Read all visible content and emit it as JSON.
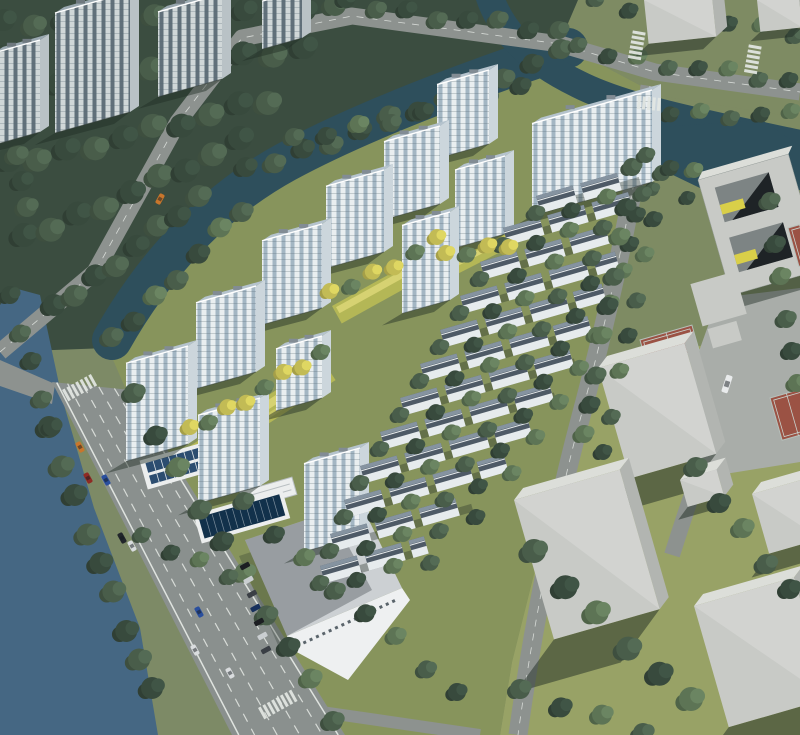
{
  "scene": {
    "kind": "aerial-architectural-rendering",
    "subject": "riverside residential development with high-rise towers, townhouse rows, canal, river, roads and context massing blocks",
    "width": 800,
    "height": 735
  },
  "palette": {
    "ground": "#7d8a66",
    "forest": "#3b4d40",
    "grass_context": "#7e8b63",
    "grass_site": "#87945c",
    "grass_sunny": "#98a266",
    "water_river": "#456783",
    "water_canal": "#2e4f5c",
    "road": "#8d928f",
    "road_arterial": "#8a908e",
    "plaza": "#a9ada9",
    "lane_white": "#dfe3df",
    "lane_dash": "#d7dbd7",
    "shadow": "rgba(32,44,36,0.45)",
    "tower_wall": "#e9eef0",
    "tower_glass": "#a3b6c3",
    "tower_roof": "#b5c3cd",
    "tower_side": "#ccd6dc",
    "old_wall": "#d0d7d8",
    "old_glass": "#61707a",
    "old_roof": "#9aa8b0",
    "old_side": "#b9c2c6",
    "th_wall": "#e6ebed",
    "th_roof": "#4e5a66",
    "th_roof_light": "#8593a0",
    "ridge": "#e9edee",
    "massing_front": "#c8cac6",
    "massing_top": "#dcded9",
    "massing_side": "#b2b5b1",
    "court_red": "#9b5244",
    "court_line": "#c9d3ce",
    "strip": "#b4b756",
    "strip_light": "#d6d272",
    "tree_dark": "#384a3d",
    "tree_mid": "#495d4a",
    "tree_light": "#5d7455",
    "tree_yellow": "#c2bb55",
    "solar_panel": "#2c4d70",
    "pool_dark": "#12314b",
    "white": "#eceeee",
    "wh_roof": "#ccd0d3",
    "wh_wall": "#eef0f1",
    "window_band": "#5a646b"
  },
  "buildings": {
    "towers": [
      [
        437,
        70,
        52,
        74
      ],
      [
        384,
        126,
        56,
        78
      ],
      [
        455,
        156,
        50,
        78
      ],
      [
        326,
        170,
        58,
        82
      ],
      [
        402,
        212,
        48,
        88
      ],
      [
        262,
        224,
        60,
        84
      ],
      [
        196,
        286,
        60,
        86
      ],
      [
        276,
        336,
        46,
        62
      ],
      [
        126,
        346,
        62,
        98
      ],
      [
        198,
        398,
        62,
        88
      ],
      [
        304,
        448,
        56,
        88
      ],
      [
        532,
        90,
        120,
        92
      ]
    ],
    "existing_towers": [
      [
        55,
        -8,
        75,
        120
      ],
      [
        158,
        -6,
        64,
        85
      ],
      [
        -6,
        40,
        46,
        92
      ],
      [
        262,
        -10,
        40,
        48
      ]
    ],
    "massing_blocks": [
      [
        598,
        368,
        90,
        115,
        42,
        -16
      ],
      [
        514,
        500,
        110,
        145,
        58,
        -16
      ],
      [
        694,
        606,
        104,
        126,
        46,
        -16
      ],
      [
        752,
        494,
        54,
        62,
        26,
        -16
      ],
      [
        680,
        480,
        38,
        28,
        14,
        -16
      ],
      [
        644,
        0,
        68,
        44,
        16,
        -6
      ],
      [
        757,
        0,
        42,
        32,
        12,
        -6
      ]
    ]
  },
  "townhouses": {
    "angle": -16,
    "rows": [
      [
        536,
        196,
        108
      ],
      [
        503,
        228,
        135
      ],
      [
        480,
        262,
        152
      ],
      [
        460,
        296,
        165
      ],
      [
        440,
        330,
        172
      ],
      [
        420,
        364,
        178
      ],
      [
        400,
        398,
        182
      ],
      [
        380,
        432,
        182
      ],
      [
        360,
        466,
        178
      ],
      [
        344,
        500,
        170
      ],
      [
        330,
        534,
        148
      ],
      [
        320,
        566,
        112
      ]
    ]
  },
  "tree_belts_back": [
    [
      10,
      25,
      330,
      10,
      12,
      11,
      "dark"
    ],
    [
      5,
      95,
      300,
      48,
      11,
      12,
      "dark"
    ],
    [
      15,
      165,
      265,
      100,
      10,
      12,
      "dark"
    ],
    [
      30,
      240,
      238,
      142,
      9,
      12,
      "dark"
    ],
    [
      60,
      310,
      198,
      196,
      8,
      11,
      "dark"
    ],
    [
      8,
      60,
      28,
      210,
      6,
      10,
      "dark"
    ],
    [
      252,
      172,
      556,
      54,
      12,
      10,
      "dark"
    ],
    [
      300,
      142,
      520,
      86,
      8,
      9,
      "mid"
    ],
    [
      352,
      4,
      558,
      30,
      8,
      9,
      "dark"
    ],
    [
      584,
      50,
      788,
      80,
      8,
      8,
      "mid"
    ],
    [
      602,
      4,
      795,
      32,
      7,
      8,
      "mid"
    ],
    [
      646,
      112,
      792,
      114,
      6,
      8,
      "mid"
    ],
    [
      658,
      194,
      795,
      202,
      5,
      7,
      "mid"
    ],
    [
      55,
      432,
      150,
      692,
      9,
      11,
      "dark"
    ],
    [
      16,
      300,
      54,
      426,
      5,
      9,
      "dark"
    ]
  ],
  "tree_belts_front": [
    [
      118,
      342,
      242,
      208,
      7,
      10,
      "mid"
    ],
    [
      638,
      172,
      582,
      438,
      9,
      9,
      "mid"
    ],
    [
      668,
      178,
      602,
      452,
      8,
      8,
      "mid"
    ],
    [
      140,
      398,
      330,
      718,
      10,
      10,
      "mid"
    ],
    [
      250,
      506,
      456,
      692,
      8,
      9,
      "mid"
    ],
    [
      540,
      556,
      692,
      702,
      6,
      12,
      "mid"
    ],
    [
      702,
      472,
      792,
      588,
      5,
      10,
      "mid"
    ],
    [
      526,
      694,
      646,
      728,
      4,
      10,
      "mid"
    ],
    [
      776,
      206,
      798,
      386,
      6,
      9,
      "mid"
    ],
    [
      196,
      432,
      320,
      352,
      8,
      8,
      "yellow"
    ],
    [
      336,
      296,
      438,
      240,
      6,
      8,
      "yellow"
    ],
    [
      452,
      258,
      512,
      242,
      4,
      8,
      "yellow"
    ],
    [
      148,
      540,
      232,
      572,
      4,
      8,
      "mid"
    ],
    [
      652,
      160,
      698,
      172,
      3,
      8,
      "mid"
    ]
  ],
  "courts": [
    [
      640,
      340,
      54,
      26
    ],
    [
      770,
      398,
      34,
      44
    ],
    [
      788,
      228,
      24,
      40
    ]
  ],
  "vehicles": {
    "cars": [
      [
        80,
        447,
        61,
        "#c8762c",
        0
      ],
      [
        88,
        478,
        61,
        "#8f2a24",
        0
      ],
      [
        106,
        480,
        61,
        "#2a4f9e",
        0
      ],
      [
        122,
        538,
        61,
        "#22262b",
        0
      ],
      [
        132,
        546,
        61,
        "#d9dcde",
        0
      ],
      [
        199,
        612,
        61,
        "#2a4f9e",
        0
      ],
      [
        195,
        650,
        61,
        "#dadddf",
        0
      ],
      [
        230,
        673,
        61,
        "#d9dcde",
        0
      ],
      [
        160,
        199,
        119,
        "#c8762c",
        0
      ],
      [
        727,
        384,
        108,
        "#e9ebec",
        1
      ]
    ],
    "parked": [
      245,
      566,
      266,
      650,
      7,
      -29
    ]
  },
  "crosswalks": [
    [
      62,
      390,
      -29,
      7
    ],
    [
      258,
      708,
      -29,
      8
    ],
    [
      628,
      58,
      -80,
      6
    ],
    [
      744,
      72,
      -80,
      6
    ],
    [
      638,
      96,
      5,
      5
    ]
  ]
}
